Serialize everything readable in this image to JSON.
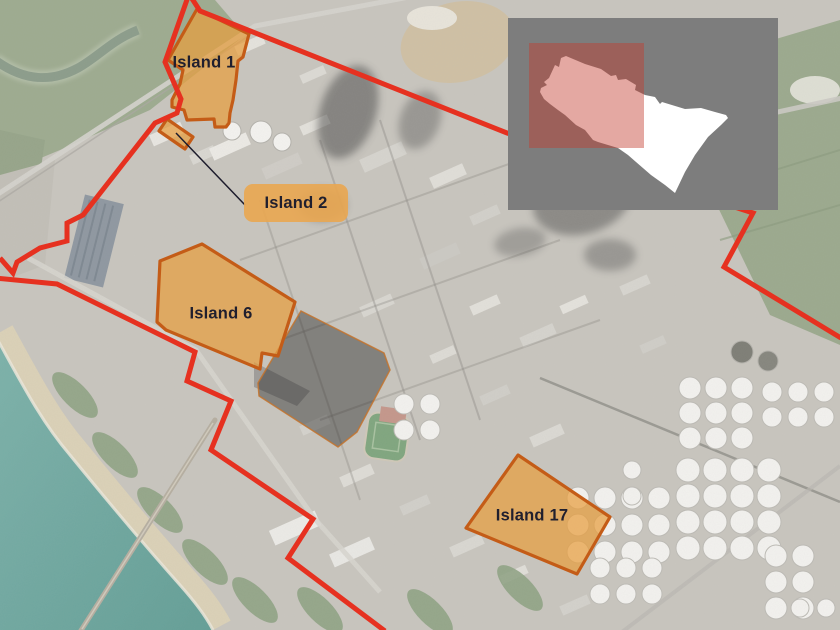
{
  "map": {
    "islands": [
      {
        "id": "island-1",
        "label": "Island 1",
        "label_pos": [
          204,
          63
        ],
        "points": [
          [
            197,
            9
          ],
          [
            249,
            34
          ],
          [
            243,
            57
          ],
          [
            238,
            61
          ],
          [
            236,
            80
          ],
          [
            233,
            100
          ],
          [
            230,
            113
          ],
          [
            229,
            123
          ],
          [
            226,
            127
          ],
          [
            215,
            127
          ],
          [
            214,
            119
          ],
          [
            187,
            120
          ],
          [
            184,
            110
          ],
          [
            172,
            107
          ],
          [
            172,
            100
          ],
          [
            180,
            84
          ],
          [
            183,
            70
          ],
          [
            168,
            60
          ]
        ]
      },
      {
        "id": "island-2",
        "label": "Island 2",
        "points": [
          [
            167,
            119
          ],
          [
            193,
            137
          ],
          [
            185,
            149
          ],
          [
            159,
            131
          ]
        ],
        "label_box": [
          244,
          184,
          104,
          38
        ],
        "leader": [
          176,
          133,
          245,
          205
        ]
      },
      {
        "id": "island-6",
        "label": "Island 6",
        "label_pos": [
          221,
          314
        ],
        "points": [
          [
            202,
            244
          ],
          [
            295,
            302
          ],
          [
            278,
            356
          ],
          [
            262,
            353
          ],
          [
            260,
            369
          ],
          [
            166,
            330
          ],
          [
            157,
            322
          ],
          [
            160,
            261
          ]
        ]
      },
      {
        "id": "island-17",
        "label": "Island 17",
        "label_pos": [
          532,
          516
        ],
        "points": [
          [
            518,
            455
          ],
          [
            610,
            517
          ],
          [
            577,
            574
          ],
          [
            466,
            528
          ]
        ]
      }
    ],
    "shaded_area": {
      "points": [
        [
          301,
          311
        ],
        [
          384,
          353
        ],
        [
          390,
          370
        ],
        [
          357,
          432
        ],
        [
          338,
          447
        ],
        [
          259,
          396
        ],
        [
          258,
          383
        ]
      ],
      "fill": "rgba(35,35,35,0.42)",
      "stroke": "rgba(195,115,45,0.85)",
      "stroke_width": 1.5
    },
    "gray_area": {
      "points": [
        [
          254,
          362
        ],
        [
          310,
          391
        ],
        [
          297,
          406
        ],
        [
          254,
          387
        ]
      ],
      "fill": "rgba(125,125,125,0.55)"
    },
    "boundary": {
      "color": "#e63120",
      "width": 5,
      "paths": [
        [
          [
            0,
            258
          ],
          [
            13,
            273
          ],
          [
            17,
            262
          ],
          [
            40,
            248
          ],
          [
            67,
            241
          ],
          [
            67,
            223
          ],
          [
            83,
            215
          ],
          [
            155,
            123
          ],
          [
            177,
            113
          ],
          [
            181,
            99
          ],
          [
            165,
            62
          ],
          [
            189,
            -6
          ],
          [
            200,
            11
          ],
          [
            283,
            44
          ],
          [
            507,
            133
          ],
          [
            753,
            213
          ],
          [
            724,
            267
          ],
          [
            841,
            338
          ]
        ],
        [
          [
            -5,
            278
          ],
          [
            57,
            284
          ],
          [
            195,
            352
          ],
          [
            187,
            381
          ],
          [
            231,
            401
          ],
          [
            211,
            450
          ],
          [
            313,
            519
          ],
          [
            288,
            558
          ],
          [
            385,
            631
          ]
        ]
      ]
    },
    "inset": {
      "x": 508,
      "y": 18,
      "w": 270,
      "h": 192,
      "bg": "#7d7d7d",
      "site_fill": "#ffffff",
      "view_rect": [
        21,
        25,
        115,
        105
      ],
      "view_fill": "rgba(196,62,48,0.45)",
      "site_outline": [
        [
          53,
          40
        ],
        [
          58,
          38
        ],
        [
          77,
          46
        ],
        [
          93,
          51
        ],
        [
          103,
          58
        ],
        [
          108,
          57
        ],
        [
          110,
          62
        ],
        [
          118,
          61
        ],
        [
          128,
          67
        ],
        [
          127,
          72
        ],
        [
          137,
          77
        ],
        [
          147,
          79
        ],
        [
          152,
          86
        ],
        [
          154,
          84
        ],
        [
          177,
          91
        ],
        [
          193,
          90
        ],
        [
          207,
          94
        ],
        [
          218,
          97
        ],
        [
          220,
          100
        ],
        [
          213,
          107
        ],
        [
          200,
          119
        ],
        [
          187,
          137
        ],
        [
          177,
          154
        ],
        [
          167,
          175
        ],
        [
          157,
          167
        ],
        [
          143,
          157
        ],
        [
          120,
          137
        ],
        [
          110,
          130
        ],
        [
          90,
          124
        ],
        [
          85,
          122
        ],
        [
          77,
          112
        ],
        [
          68,
          107
        ],
        [
          57,
          97
        ],
        [
          50,
          92
        ],
        [
          42,
          86
        ],
        [
          36,
          81
        ],
        [
          32,
          74
        ],
        [
          33,
          70
        ],
        [
          39,
          67
        ],
        [
          36,
          64
        ],
        [
          41,
          60
        ],
        [
          47,
          47
        ],
        [
          51,
          49
        ]
      ]
    },
    "style": {
      "island_fill": "rgba(232,158,62,0.72)",
      "island_stroke": "#c45c17",
      "island_stroke_width": 3.2,
      "label_color": "#201f2e",
      "label_box_fill": "rgba(232,167,82,0.92)",
      "leader_color": "#1d1c2c"
    }
  }
}
